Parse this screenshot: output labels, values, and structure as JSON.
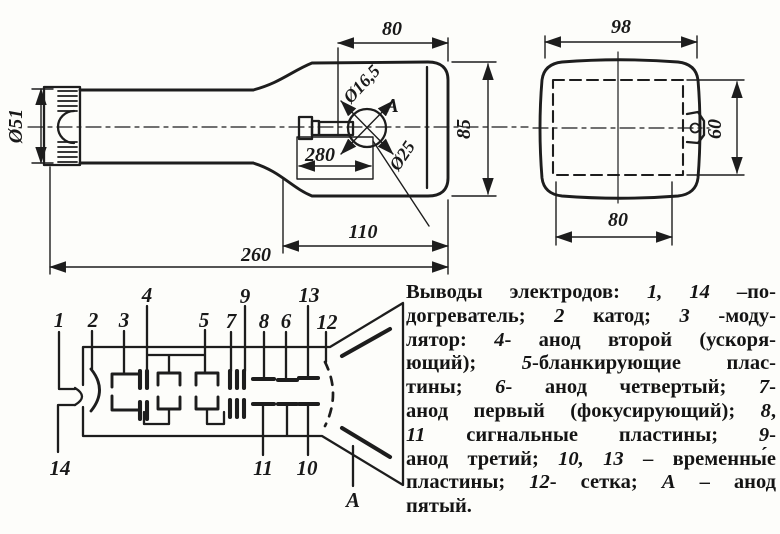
{
  "figure_title": "CRT tube outline drawing with electrode schematic",
  "side_view": {
    "dim_80": "80",
    "dim_110": "110",
    "dim_260": "260",
    "dim_280": "280",
    "dim_dia51": "Ø51",
    "dim_85": "85",
    "dim_dia165": "Ø16,5",
    "dim_dia25": "Ø25",
    "anode_label": "A"
  },
  "front_view": {
    "dim_98": "98",
    "dim_60": "60",
    "dim_80": "80"
  },
  "schematic": {
    "pins": {
      "p1": "1",
      "p2": "2",
      "p3": "3",
      "p4": "4",
      "p5": "5",
      "p6": "6",
      "p7": "7",
      "p8": "8",
      "p9": "9",
      "p10": "10",
      "p11": "11",
      "p12": "12",
      "p13": "13",
      "p14": "14",
      "pa": "А"
    }
  },
  "caption": {
    "lines": [
      [
        {
          "t": "Выводы электродов: "
        },
        {
          "t": "1, 14",
          "i": true
        },
        {
          "t": " –по-"
        }
      ],
      [
        {
          "t": "догреватель; "
        },
        {
          "t": "2",
          "i": true
        },
        {
          "t": " катод; "
        },
        {
          "t": "3",
          "i": true
        },
        {
          "t": " -моду-"
        }
      ],
      [
        {
          "t": "лятор: "
        },
        {
          "t": "4",
          "i": true
        },
        {
          "t": "- анод второй (ускоря-"
        }
      ],
      [
        {
          "t": "ющий); "
        },
        {
          "t": "5",
          "i": true
        },
        {
          "t": "-бланкирующие плас-"
        }
      ],
      [
        {
          "t": "тины; "
        },
        {
          "t": "6",
          "i": true
        },
        {
          "t": "- анод четвертый; "
        },
        {
          "t": "7",
          "i": true
        },
        {
          "t": "-"
        }
      ],
      [
        {
          "t": "анод первый (фокусирующий); "
        },
        {
          "t": "8",
          "i": true
        },
        {
          "t": ","
        }
      ],
      [
        {
          "t": "11",
          "i": true
        },
        {
          "t": " сигнальные пластины; "
        },
        {
          "t": "9",
          "i": true
        },
        {
          "t": "-"
        }
      ],
      [
        {
          "t": "анод третий; "
        },
        {
          "t": "10, 13",
          "i": true
        },
        {
          "t": " – временны́е"
        }
      ],
      [
        {
          "t": "пластины; "
        },
        {
          "t": "12",
          "i": true
        },
        {
          "t": "- сетка; "
        },
        {
          "t": "А",
          "i": true
        },
        {
          "t": " – анод"
        }
      ],
      [
        {
          "t": "пятый."
        }
      ]
    ]
  },
  "colors": {
    "ink": "#1d1d1d",
    "paper": "#fdfdfa"
  }
}
